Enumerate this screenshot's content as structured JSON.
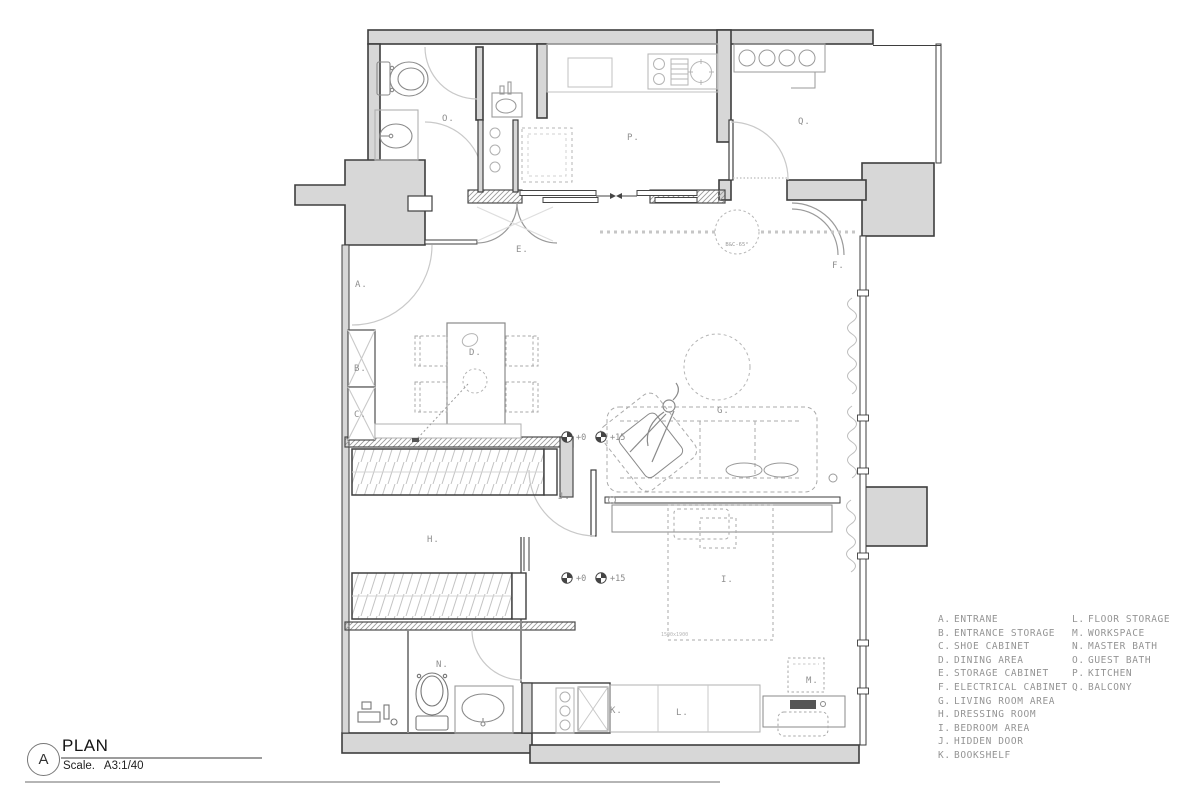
{
  "title_block": {
    "sheet_letter": "A",
    "name": "PLAN",
    "scale": "Scale.   A3:1/40"
  },
  "legend": {
    "columns": [
      {
        "items": [
          {
            "key": "A.",
            "label": "ENTRANE"
          },
          {
            "key": "B.",
            "label": "ENTRANCE STORAGE"
          },
          {
            "key": "C.",
            "label": "SHOE CABINET"
          },
          {
            "key": "D.",
            "label": "DINING AREA"
          },
          {
            "key": "E.",
            "label": "STORAGE CABINET"
          },
          {
            "key": "F.",
            "label": "ELECTRICAL CABINET"
          },
          {
            "key": "G.",
            "label": "LIVING ROOM AREA"
          },
          {
            "key": "H.",
            "label": "DRESSING ROOM"
          },
          {
            "key": "I.",
            "label": "BEDROOM AREA"
          },
          {
            "key": "J.",
            "label": "HIDDEN DOOR"
          },
          {
            "key": "K.",
            "label": "BOOKSHELF"
          }
        ]
      },
      {
        "items": [
          {
            "key": "L.",
            "label": "FLOOR STORAGE"
          },
          {
            "key": "M.",
            "label": "WORKSPACE"
          },
          {
            "key": "N.",
            "label": "MASTER BATH"
          },
          {
            "key": "O.",
            "label": "GUEST BATH"
          },
          {
            "key": "P.",
            "label": "KITCHEN"
          },
          {
            "key": "Q.",
            "label": "BALCONY"
          }
        ]
      }
    ]
  },
  "plan": {
    "labels": {
      "A": "A.",
      "B": "B.",
      "C": "C.",
      "D": "D.",
      "E": "E.",
      "F": "F.",
      "G": "G.",
      "H": "H.",
      "I": "I.",
      "J": "J.",
      "K": "K.",
      "L": "L.",
      "M": "M.",
      "N": "N.",
      "O": "O.",
      "P": "P.",
      "Q": "Q."
    },
    "level_markers": {
      "m1": "+0",
      "m2": "+15",
      "m3": "+0",
      "m4": "+15"
    },
    "bed_dimension": "1500x1900",
    "door_note": "B&C-65°"
  },
  "colors": {
    "wall_fill": "#d7d7d7",
    "wall_stroke": "#3e3e3e",
    "furniture_stroke": "#a0a0a0",
    "label_text": "#8f8f8f",
    "title_text": "#141414"
  }
}
